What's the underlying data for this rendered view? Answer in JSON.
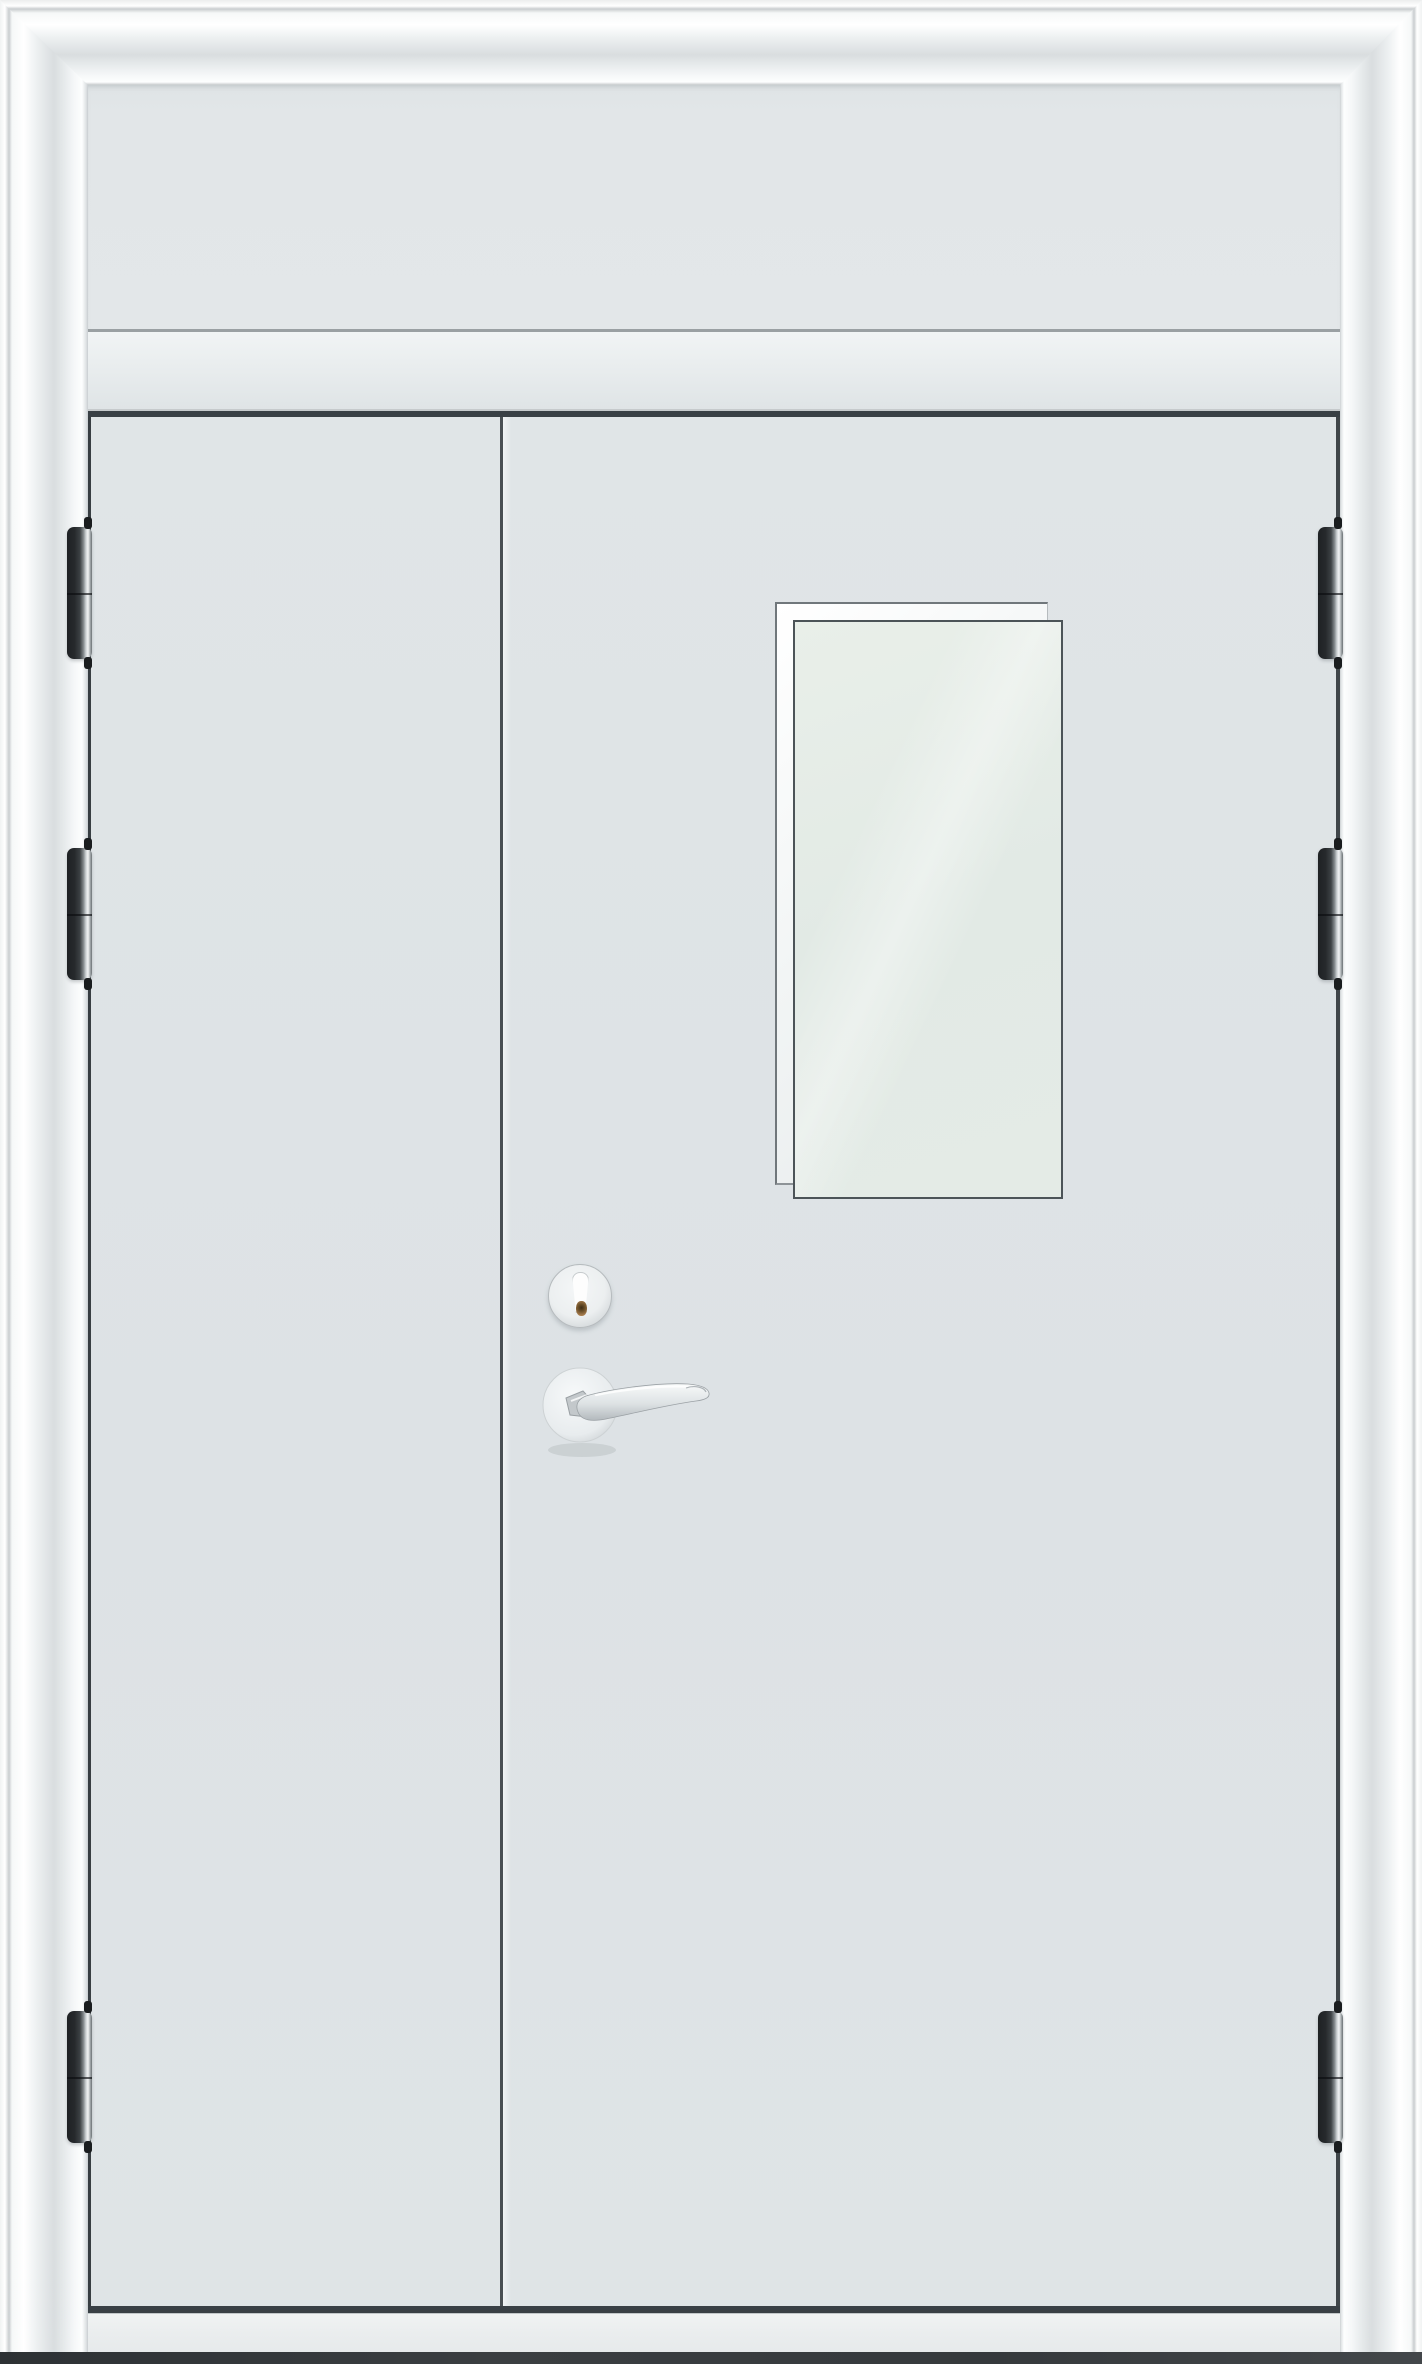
{
  "image": {
    "type": "product-photograph",
    "subject": "Unequal double-leaf steel fire door with transom panel, vision window, lever handle and lock cylinder",
    "text_visible": "none"
  },
  "door": {
    "frame_label": "glossy white steel door frame (architrave)",
    "transom_panel_label": "transom panel",
    "transom_rail_label": "transom rail",
    "leaves": {
      "count": 2,
      "left_label": "inactive leaf",
      "right_label": "active leaf",
      "surface": "light grey steel"
    },
    "vision_window_label": "vision window with white glazing bead and frosted glass",
    "hinges": {
      "count": 6,
      "per_side": 3,
      "finish": "dark steel barrel with polished edge"
    },
    "lock_cylinder_label": "lock cylinder with brass keyway",
    "handle_label": "satin silver lever handle on round rose",
    "threshold_label": "threshold sill",
    "floor_label": "dark floor line"
  },
  "colors": {
    "frame-white": "#fafcfc",
    "frame-shadow": "#d9dddf",
    "panel": "#e2e6e8",
    "door-surface": "#dde2e5",
    "door-highlight": "#f0f3f4",
    "divider": "#4a5054",
    "line-dark": "#394045",
    "glass": "#e2eae5",
    "hinge-dark": "#26292c",
    "metal-light": "#f4f6f7",
    "metal-dark": "#c2c8cb",
    "keyway-brass": "#a67c4e",
    "sill": "#eaedee",
    "floor": "#35393c"
  },
  "geometry": {
    "canvas": {
      "width": 1422,
      "height": 2364
    },
    "hinge_size": {
      "width": 25,
      "height": 132
    },
    "hinges_y": [
      527,
      848,
      2011
    ],
    "hinge_x": {
      "left": 67,
      "right": 1318
    },
    "pin_x": {
      "left": 84,
      "right": 1334
    }
  }
}
